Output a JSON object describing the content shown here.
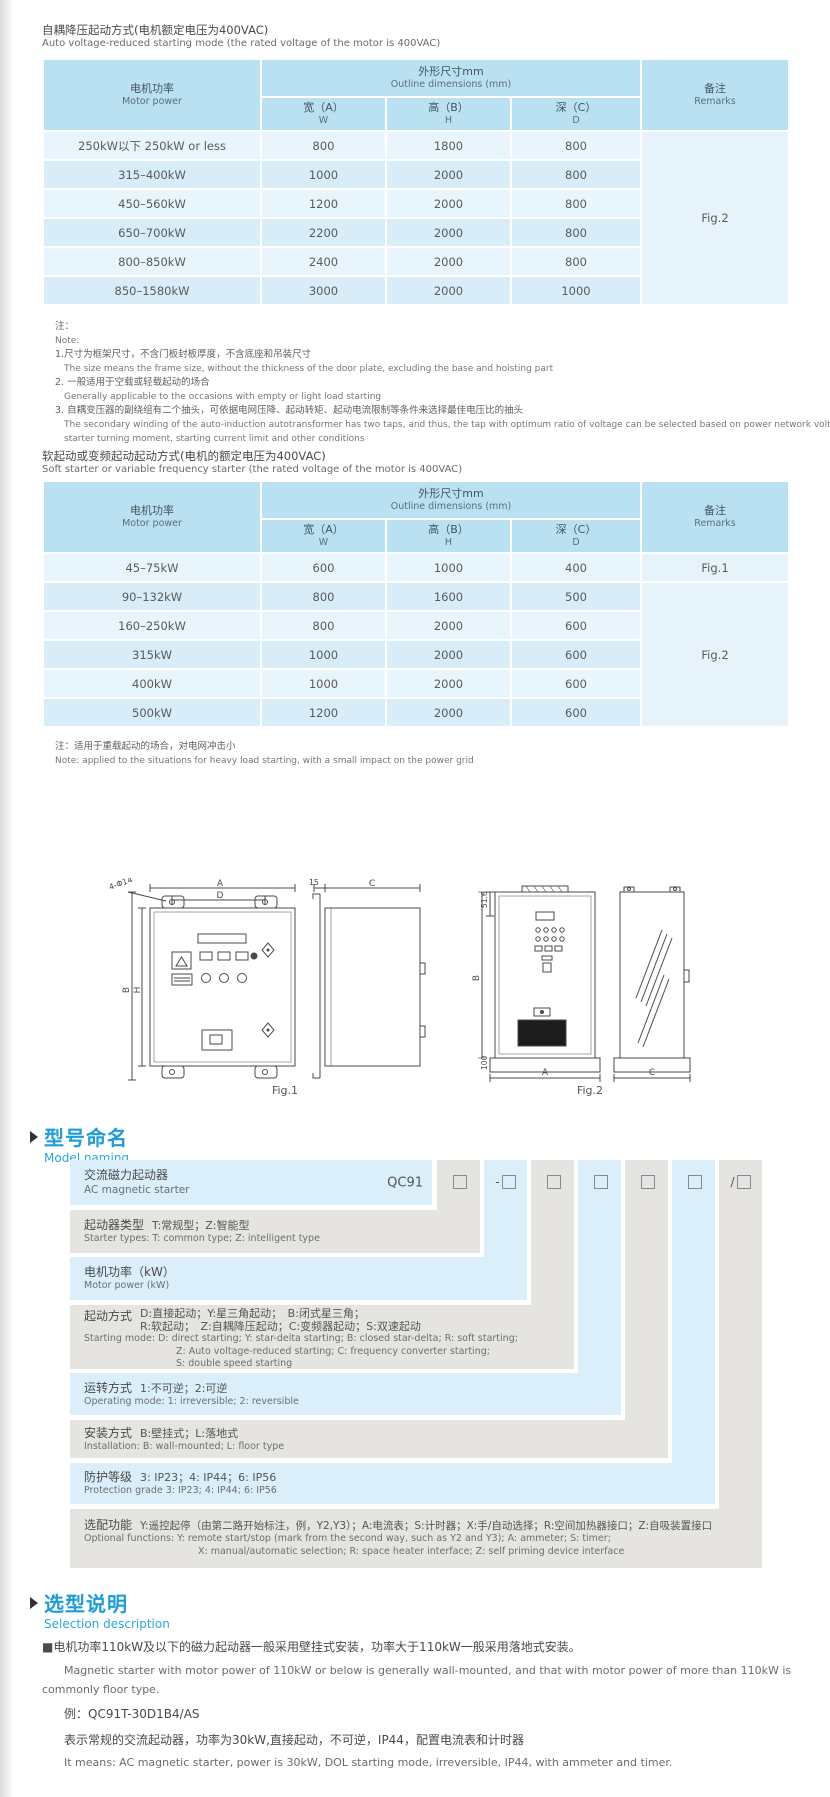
{
  "sections": {
    "auto": {
      "title_cn": "自耦降压起动方式(电机额定电压为400VAC)",
      "title_en": "Auto voltage-reduced starting mode (the rated voltage of the motor is 400VAC)"
    },
    "soft": {
      "title_cn": "软起动或变频起动起动方式(电机的额定电压为400VAC)",
      "title_en": "Soft starter or variable frequency starter (the rated voltage of the motor is 400VAC)"
    }
  },
  "table_header": {
    "motor_cn": "电机功率",
    "motor_en": "Motor power",
    "outline_cn": "外形尺寸mm",
    "outline_en": "Outline dimensions (mm)",
    "w_cn": "宽（A）",
    "w_en": "W",
    "h_cn": "高（B）",
    "h_en": "H",
    "d_cn": "深（C）",
    "d_en": "D",
    "remarks_cn": "备注",
    "remarks_en": "Remarks"
  },
  "table1": {
    "rows": [
      {
        "power": "250kW以下 250kW or less",
        "w": "800",
        "h": "1800",
        "d": "800"
      },
      {
        "power": "315–400kW",
        "w": "1000",
        "h": "2000",
        "d": "800"
      },
      {
        "power": "450–560kW",
        "w": "1200",
        "h": "2000",
        "d": "800"
      },
      {
        "power": "650–700kW",
        "w": "2200",
        "h": "2000",
        "d": "800"
      },
      {
        "power": "800–850kW",
        "w": "2400",
        "h": "2000",
        "d": "800"
      },
      {
        "power": "850–1580kW",
        "w": "3000",
        "h": "2000",
        "d": "1000"
      }
    ],
    "remark": "Fig.2"
  },
  "notes1": [
    "注：",
    "Note:",
    "1.尺寸为框架尺寸，不含门板封板厚度，不含底座和吊装尺寸",
    "The size means the frame size, without the thickness of the door plate, excluding the base and hoisting part",
    "2. 一般适用于空载或轻载起动的场合",
    "Generally applicable to the occasions with empty or light load starting",
    "3. 自耦变压器的副绕组有二个抽头，可依据电网压降、起动转矩、起动电流限制等条件来选择最佳电压比的抽头",
    "The secondary winding of the auto-induction autotransformer has two taps, and thus, the tap with optimum ratio of voltage can be selected based on power network voltage drop,",
    "starter turning moment, starting current limit and other conditions"
  ],
  "table2": {
    "rows": [
      {
        "power": "45–75kW",
        "w": "600",
        "h": "1000",
        "d": "400"
      },
      {
        "power": "90–132kW",
        "w": "800",
        "h": "1600",
        "d": "500"
      },
      {
        "power": "160–250kW",
        "w": "800",
        "h": "2000",
        "d": "600"
      },
      {
        "power": "315kW",
        "w": "1000",
        "h": "2000",
        "d": "600"
      },
      {
        "power": "400kW",
        "w": "1000",
        "h": "2000",
        "d": "600"
      },
      {
        "power": "500kW",
        "w": "1200",
        "h": "2000",
        "d": "600"
      }
    ],
    "remark_row1": "Fig.1",
    "remark_rest": "Fig.2"
  },
  "note2": {
    "cn": "注：适用于重载起动的场合，对电网冲击小",
    "en": "Note: applied to the situations for heavy load starting, with a small impact on the power grid"
  },
  "figures": {
    "fig1_label": "Fig.1",
    "fig2_label": "Fig.2",
    "dims": {
      "a": "A",
      "b": "B",
      "c": "C",
      "d": "D",
      "h": "H",
      "t15": "15",
      "holes": "4-Φ14",
      "top516": "51.6",
      "h100": "100"
    }
  },
  "naming": {
    "title_cn": "型号命名",
    "title_en": "Model naming",
    "product_cn": "交流磁力起动器",
    "product_en": "AC magnetic starter",
    "prefix": "QC91",
    "box_prefixes": [
      "",
      "-",
      "",
      "",
      "",
      "",
      "/"
    ],
    "rows": [
      {
        "label": "起动器类型",
        "desc": "T:常规型；Z:智能型",
        "en1": "Starter types: T: common type; Z: intelligent type"
      },
      {
        "label": "电机功率（kW）",
        "desc": "",
        "en1": "Motor power (kW)"
      },
      {
        "label": "起动方式",
        "desc1": "D:直接起动；Y:星三角起动；　B:闭式星三角；",
        "desc2": "R:软起动；　Z:自耦降压起动；C:变频器起动；S:双速起动",
        "en1": "Starting mode: D: direct starting; Y: star-delta starting; B: closed star-delta; R: soft starting;",
        "en2": "Z: Auto voltage-reduced starting; C: frequency converter starting;",
        "en3": "S: double speed starting"
      },
      {
        "label": "运转方式",
        "desc": "1:不可逆；2:可逆",
        "en1": "Operating mode: 1: irreversible; 2: reversible"
      },
      {
        "label": "安装方式",
        "desc": "B:壁挂式；L:落地式",
        "en1": "Installation: B: wall-mounted;  L: floor type"
      },
      {
        "label": "防护等级",
        "desc": "3: IP23；4: IP44；6: IP56",
        "en1": "Protection grade  3: IP23;  4: IP44;  6: IP56"
      },
      {
        "label": "选配功能",
        "desc": "Y:遥控起停（由第二路开始标注，例，Y2,Y3）；A:电流表；S:计时器；X:手/自动选择；R:空间加热器接口；Z:自吸装置接口",
        "en1": "Optional functions: Y: remote start/stop (mark from the second way, such as Y2 and Y3); A: ammeter; S: timer;",
        "en2": "X: manual/automatic selection; R: space heater interface; Z: self priming device interface"
      }
    ]
  },
  "selection": {
    "title_cn": "选型说明",
    "title_en": "Selection description",
    "p1_cn": "■电机功率110kW及以下的磁力起动器一般采用壁挂式安装，功率大于110kW一般采用落地式安装。",
    "p1_en1": "Magnetic starter with motor power of 110kW or below is generally wall-mounted, and that with motor power of more than 110kW is",
    "p1_en2": "commonly floor type.",
    "example": "例：QC91T-30D1B4/AS",
    "ex_cn": "表示常规的交流起动器，功率为30kW,直接起动，不可逆，IP44，配置电流表和计时器",
    "ex_en": "It means: AC magnetic starter, power is 30kW, DOL starting mode, irreversible, IP44, with ammeter and timer."
  }
}
